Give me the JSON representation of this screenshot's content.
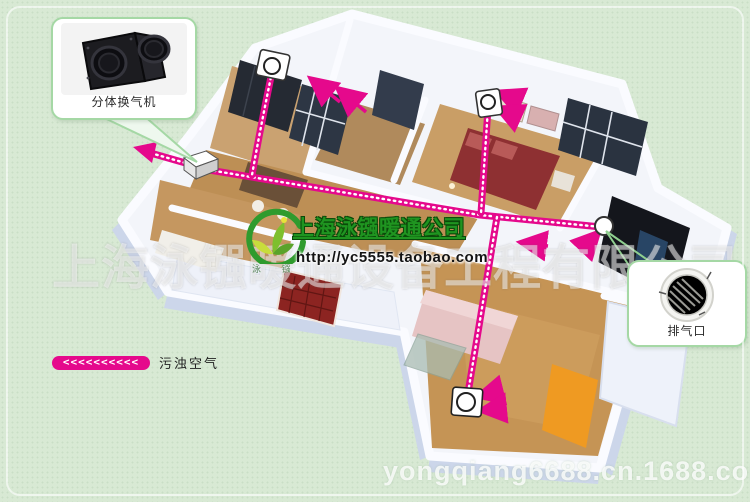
{
  "brand": {
    "company": "上海泳镪暖通公司",
    "url": "http://yc5555.taobao.com",
    "logo_caption": "泳 镪"
  },
  "watermarks": {
    "company_full": "上海泳镪暖通设备工程有限公司",
    "site": "yongqiang6688.cn.1688.com"
  },
  "callouts": {
    "fan": {
      "label": "分体换气机"
    },
    "vent": {
      "label": "排气口"
    }
  },
  "legend": {
    "chevrons": "<<<<<<<<<<",
    "label": "污浊空气"
  },
  "colors": {
    "background": "#d8e9d4",
    "accent_magenta": "#e5098c",
    "callout_border": "#a5d8a5",
    "title_green": "#1f9420"
  }
}
